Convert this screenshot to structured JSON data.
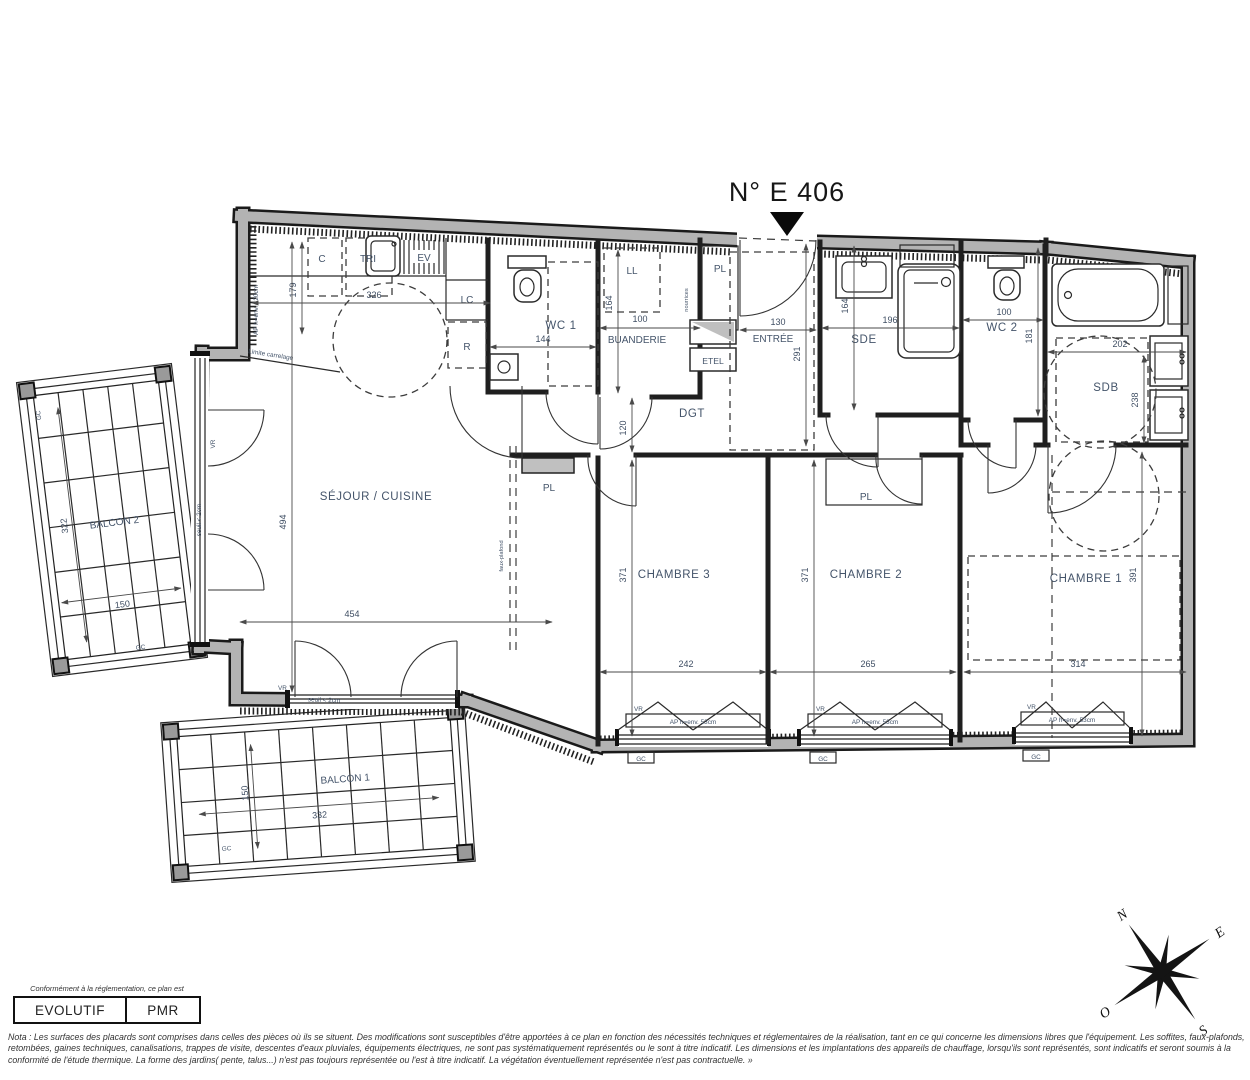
{
  "title": "N° E 406",
  "rooms": {
    "sejour": "SÉJOUR / CUISINE",
    "chambre1": "CHAMBRE 1",
    "chambre2": "CHAMBRE 2",
    "chambre3": "CHAMBRE 3",
    "wc1": "WC 1",
    "wc2": "WC 2",
    "sde": "SDE",
    "sdb": "SDB",
    "buanderie": "BUANDERIE",
    "entree": "ENTRÉE",
    "dgt": "DGT",
    "balcon1": "BALCON 1",
    "balcon2": "BALCON 2"
  },
  "equipment": {
    "c": "C",
    "tri": "TRI",
    "ev": "EV",
    "lc": "LC",
    "r": "R",
    "ll": "LL",
    "etel": "ETEL",
    "pl": "PL"
  },
  "annotations": {
    "vr": "VR",
    "gc": "GC",
    "seuil": "seuil < 2cm",
    "ap120": "AP h=env. 120cm",
    "ap53": "AP h=env. 53cm",
    "limite": "Limite carrelage",
    "nourrices": "nourrices",
    "faux_plafond": "faux-plafond"
  },
  "dimensions": {
    "sejour_w": "454",
    "sejour_h": "494",
    "kitchen_w": "326",
    "kitchen_h": "179",
    "wc1_w": "144",
    "buanderie_w": "100",
    "buanderie_h": "164",
    "dgt_h": "120",
    "entree_w": "130",
    "entree_h": "291",
    "sde_w": "196",
    "sde_h": "164",
    "wc2_w": "100",
    "wc2_h": "181",
    "sdb_w": "202",
    "sdb_h": "238",
    "ch3_w": "242",
    "ch3_h": "371",
    "ch2_w": "265",
    "ch2_h": "371",
    "ch1_w": "314",
    "ch1_h": "391",
    "balcon1_w": "332",
    "balcon1_h": "150",
    "balcon2_w": "150",
    "balcon2_h": "322"
  },
  "compass": {
    "n": "N",
    "e": "E",
    "s": "S",
    "o": "O"
  },
  "legend": {
    "intro": "Conformément à la réglementation, ce plan est",
    "items": [
      "EVOLUTIF",
      "PMR"
    ]
  },
  "nota": "Nota : Les surfaces des placards sont comprises dans celles des pièces où ils se situent. Des modifications sont susceptibles d'être apportées à ce plan en fonction des nécessités techniques et réglementaires de la réalisation, tant en ce qui concerne les dimensions libres que l'équipement.  Les soffites, faux-plafonds, retombées, gaines techniques, canalisations, trappes de visite, descentes d'eaux pluviales, équipements électriques, ne sont pas systématiquement représentés ou le sont à titre indicatif. Les dimensions et les implantations des appareils de chauffage, lorsqu'ils sont représentés, sont indicatifs et seront soumis à la conformité de l'étude thermique. La forme des jardins( pente, talus...) n'est pas toujours représentée ou l'est à titre indicatif. La végétation éventuellement représentée n'est pas contractuelle. »"
}
